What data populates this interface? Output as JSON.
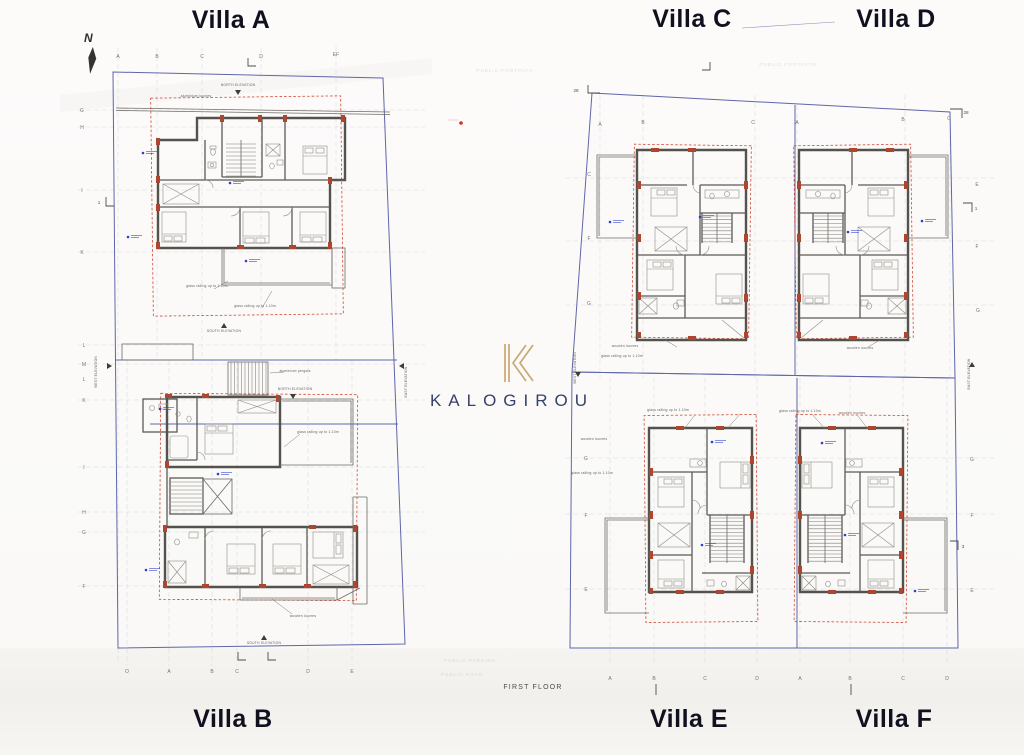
{
  "page": {
    "floor_label": "FIRST FLOOR"
  },
  "brand": {
    "name": "KALOGIROU",
    "monogram": "K",
    "gold": "#c8a873",
    "navy": "#36426a"
  },
  "compass": {
    "label": "N"
  },
  "villa_labels": {
    "a": "Villa A",
    "b": "Villa B",
    "c": "Villa C",
    "d": "Villa D",
    "e": "Villa E",
    "f": "Villa F"
  },
  "colors": {
    "plot_boundary": "#5e66aa",
    "setback_dashed": "#cf4a33",
    "walls": "#54524d",
    "columns": "#ae452f",
    "grid_lines": "#cdcdd3",
    "spot_marker": "#2b3fd0",
    "red_dot": "#d03325"
  },
  "plan_texts": {
    "grid_letters": [
      {
        "t": "A",
        "x": 118,
        "y": 58
      },
      {
        "t": "B",
        "x": 157,
        "y": 58
      },
      {
        "t": "C",
        "x": 202,
        "y": 58
      },
      {
        "t": "D",
        "x": 261,
        "y": 58
      },
      {
        "t": "EF",
        "x": 336,
        "y": 56
      },
      {
        "t": "G",
        "x": 82,
        "y": 112
      },
      {
        "t": "H",
        "x": 82,
        "y": 129
      },
      {
        "t": "I",
        "x": 82,
        "y": 192
      },
      {
        "t": "K",
        "x": 82,
        "y": 254
      },
      {
        "t": "L",
        "x": 84,
        "y": 347
      },
      {
        "t": "M",
        "x": 84,
        "y": 366
      },
      {
        "t": "L",
        "x": 84,
        "y": 381
      },
      {
        "t": "K",
        "x": 84,
        "y": 402
      },
      {
        "t": "I",
        "x": 84,
        "y": 469
      },
      {
        "t": "H",
        "x": 84,
        "y": 514
      },
      {
        "t": "G",
        "x": 84,
        "y": 534
      },
      {
        "t": "F",
        "x": 84,
        "y": 588
      },
      {
        "t": "O",
        "x": 127,
        "y": 673
      },
      {
        "t": "A",
        "x": 169,
        "y": 673
      },
      {
        "t": "B",
        "x": 212,
        "y": 673
      },
      {
        "t": "C",
        "x": 237,
        "y": 673
      },
      {
        "t": "D",
        "x": 308,
        "y": 673
      },
      {
        "t": "E",
        "x": 352,
        "y": 673
      },
      {
        "t": "A",
        "x": 600,
        "y": 126
      },
      {
        "t": "B",
        "x": 643,
        "y": 124
      },
      {
        "t": "C",
        "x": 753,
        "y": 124
      },
      {
        "t": "A",
        "x": 797,
        "y": 124
      },
      {
        "t": "B",
        "x": 903,
        "y": 121
      },
      {
        "t": "C",
        "x": 949,
        "y": 120
      },
      {
        "t": "C",
        "x": 589,
        "y": 176
      },
      {
        "t": "F",
        "x": 589,
        "y": 240
      },
      {
        "t": "G",
        "x": 589,
        "y": 305
      },
      {
        "t": "E",
        "x": 977,
        "y": 186
      },
      {
        "t": "F",
        "x": 977,
        "y": 248
      },
      {
        "t": "G",
        "x": 978,
        "y": 312
      },
      {
        "t": "G",
        "x": 586,
        "y": 460
      },
      {
        "t": "F",
        "x": 586,
        "y": 517
      },
      {
        "t": "E",
        "x": 586,
        "y": 591
      },
      {
        "t": "G",
        "x": 972,
        "y": 461
      },
      {
        "t": "F",
        "x": 972,
        "y": 517
      },
      {
        "t": "E",
        "x": 972,
        "y": 592
      },
      {
        "t": "A",
        "x": 610,
        "y": 680
      },
      {
        "t": "B",
        "x": 654,
        "y": 680
      },
      {
        "t": "C",
        "x": 705,
        "y": 680
      },
      {
        "t": "D",
        "x": 757,
        "y": 680
      },
      {
        "t": "A",
        "x": 800,
        "y": 680
      },
      {
        "t": "B",
        "x": 850,
        "y": 680
      },
      {
        "t": "C",
        "x": 903,
        "y": 680
      },
      {
        "t": "D",
        "x": 947,
        "y": 680
      }
    ],
    "sections": [
      {
        "t": "28",
        "x": 576,
        "y": 92
      },
      {
        "t": "28",
        "x": 966,
        "y": 114
      },
      {
        "t": "1",
        "x": 976,
        "y": 210
      },
      {
        "t": "3",
        "x": 963,
        "y": 548
      },
      {
        "t": "1",
        "x": 99,
        "y": 204
      }
    ],
    "annotations": [
      {
        "t": "NORTH ELEVATION",
        "x": 238,
        "y": 86
      },
      {
        "t": "aluminium louvres",
        "x": 196,
        "y": 97
      },
      {
        "t": "SOUTH ELEVATION",
        "x": 224,
        "y": 332
      },
      {
        "t": "aluminium pergola",
        "x": 295,
        "y": 372
      },
      {
        "t": "NORTH ELEVATION",
        "x": 295,
        "y": 390
      },
      {
        "t": "glass railing up to 1.10m",
        "x": 318,
        "y": 433
      },
      {
        "t": "glass railing up to 1.10m",
        "x": 207,
        "y": 287
      },
      {
        "t": "glass railing up to 1.10m",
        "x": 255,
        "y": 307
      },
      {
        "t": "wooden louvres",
        "x": 303,
        "y": 617
      },
      {
        "t": "SOUTH ELEVATION",
        "x": 264,
        "y": 644
      },
      {
        "t": "WEST ELEVATION",
        "x": 97,
        "y": 372,
        "rot": -90
      },
      {
        "t": "EAST ELEVATION",
        "x": 407,
        "y": 382,
        "rot": -90
      },
      {
        "t": "WEST ELEVATION",
        "x": 576,
        "y": 368,
        "rot": -90
      },
      {
        "t": "EAST ELEVATION",
        "x": 970,
        "y": 374,
        "rot": -90
      },
      {
        "t": "wooden louvres",
        "x": 625,
        "y": 347
      },
      {
        "t": "glass railing up to 1.10m",
        "x": 622,
        "y": 357
      },
      {
        "t": "wooden louvres",
        "x": 860,
        "y": 349
      },
      {
        "t": "glass railing up to 1.10m",
        "x": 800,
        "y": 412
      },
      {
        "t": "wooden louvres",
        "x": 852,
        "y": 414
      },
      {
        "t": "glass railing up to 1.10m",
        "x": 668,
        "y": 411
      },
      {
        "t": "wooden louvres",
        "x": 594,
        "y": 440
      },
      {
        "t": "glass railing up to 1.10m",
        "x": 592,
        "y": 474
      }
    ],
    "faint": [
      {
        "t": "PUBLIC FOOTPATH",
        "x": 505,
        "y": 72
      },
      {
        "t": "PUBLIC FOOTPATH",
        "x": 788,
        "y": 66
      },
      {
        "t": "PUBLIC PARKING",
        "x": 470,
        "y": 662
      },
      {
        "t": "PUBLIC ROAD",
        "x": 462,
        "y": 676
      }
    ]
  },
  "spot_markers": [
    {
      "x": 143,
      "y": 153
    },
    {
      "x": 230,
      "y": 183
    },
    {
      "x": 128,
      "y": 237
    },
    {
      "x": 246,
      "y": 261
    },
    {
      "x": 160,
      "y": 409
    },
    {
      "x": 218,
      "y": 474
    },
    {
      "x": 146,
      "y": 570
    },
    {
      "x": 610,
      "y": 222
    },
    {
      "x": 700,
      "y": 217
    },
    {
      "x": 848,
      "y": 232
    },
    {
      "x": 922,
      "y": 221
    },
    {
      "x": 712,
      "y": 442
    },
    {
      "x": 702,
      "y": 545
    },
    {
      "x": 822,
      "y": 443
    },
    {
      "x": 845,
      "y": 535
    },
    {
      "x": 915,
      "y": 591
    }
  ]
}
